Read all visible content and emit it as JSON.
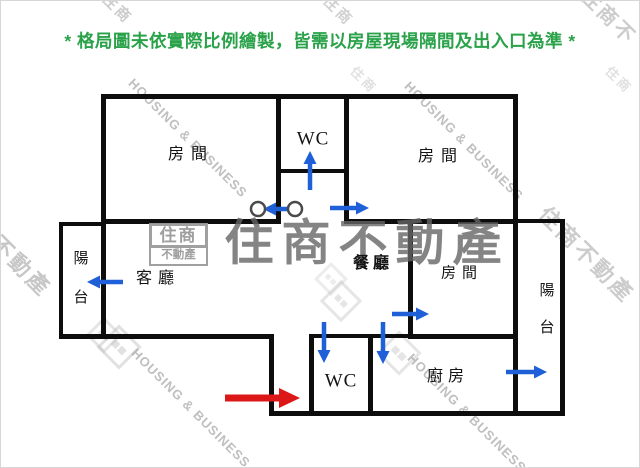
{
  "disclaimer": "* 格局圖未依實際比例繪製，皆需以房屋現場隔間及出入口為準 *",
  "colors": {
    "green": "#2aa24a",
    "blue": "#1f5fd8",
    "red": "#dc1717",
    "wall": "#0d0d0d",
    "label": "#141414",
    "watermark_dark": "#666666",
    "watermark_light": "#9a9a9a"
  },
  "brand": {
    "name_cjk": "住商不動產",
    "name_en": "HOUSING & BUSINESS",
    "logo_top": "住商",
    "logo_bottom": "不動產"
  },
  "rooms": [
    {
      "n": "bedroom-top-left",
      "label": "房間",
      "x": 190,
      "y": 154,
      "fs": 16,
      "ls": 7
    },
    {
      "n": "wc-top",
      "label": "WC",
      "x": 312,
      "y": 138,
      "fs": 19,
      "ls": 1
    },
    {
      "n": "bedroom-top-right",
      "label": "房間",
      "x": 440,
      "y": 156,
      "fs": 16,
      "ls": 7
    },
    {
      "n": "balcony-left",
      "label": "陽台",
      "x": 80,
      "y": 278,
      "fs": 15,
      "vertical": true,
      "gap": 24
    },
    {
      "n": "living-room",
      "label": "客廳",
      "x": 157,
      "y": 278,
      "fs": 16,
      "ls": 6
    },
    {
      "n": "dining-room",
      "label": "餐廳",
      "x": 372,
      "y": 263,
      "fs": 16,
      "ls": 4,
      "bold": true
    },
    {
      "n": "bedroom-middle-right",
      "label": "房間",
      "x": 461,
      "y": 273,
      "fs": 15,
      "ls": 6
    },
    {
      "n": "balcony-right",
      "label": "陽台",
      "x": 546,
      "y": 309,
      "fs": 15,
      "vertical": true,
      "gap": 22
    },
    {
      "n": "wc-bottom",
      "label": "WC",
      "x": 340,
      "y": 380,
      "fs": 19,
      "ls": 1
    },
    {
      "n": "kitchen",
      "label": "廚房",
      "x": 447,
      "y": 376,
      "fs": 16,
      "ls": 5
    }
  ],
  "walls": [
    {
      "n": "wall-top",
      "x": 100,
      "y": 93,
      "w": 417,
      "h": 5
    },
    {
      "n": "wall-left",
      "x": 100,
      "y": 93,
      "w": 5,
      "h": 245
    },
    {
      "n": "wall-balcony-left-top",
      "x": 58,
      "y": 221,
      "w": 46,
      "h": 4
    },
    {
      "n": "wall-balcony-left-side",
      "x": 58,
      "y": 221,
      "w": 4,
      "h": 116
    },
    {
      "n": "wall-living-bottom",
      "x": 58,
      "y": 333,
      "w": 215,
      "h": 5
    },
    {
      "n": "wall-entry-step",
      "x": 268,
      "y": 333,
      "w": 5,
      "h": 81
    },
    {
      "n": "wall-bottom",
      "x": 268,
      "y": 410,
      "w": 296,
      "h": 5
    },
    {
      "n": "wall-corridor-left",
      "x": 275,
      "y": 93,
      "w": 5,
      "h": 130
    },
    {
      "n": "wall-corridor-right",
      "x": 343,
      "y": 93,
      "w": 5,
      "h": 130
    },
    {
      "n": "wall-wc-top-bottom",
      "x": 275,
      "y": 168,
      "w": 72,
      "h": 4
    },
    {
      "n": "wall-bedroom1-bottom",
      "x": 100,
      "y": 218,
      "w": 180,
      "h": 5
    },
    {
      "n": "wall-bedroom2-bottom",
      "x": 343,
      "y": 218,
      "w": 174,
      "h": 5
    },
    {
      "n": "wall-right-main",
      "x": 512,
      "y": 93,
      "w": 5,
      "h": 322
    },
    {
      "n": "wall-balcony-right-top",
      "x": 512,
      "y": 218,
      "w": 51,
      "h": 4
    },
    {
      "n": "wall-balcony-right-side",
      "x": 559,
      "y": 218,
      "w": 5,
      "h": 197
    },
    {
      "n": "wall-bedroom3-left",
      "x": 407,
      "y": 218,
      "w": 5,
      "h": 120
    },
    {
      "n": "wall-bedroom3-bottom",
      "x": 407,
      "y": 333,
      "w": 110,
      "h": 5
    },
    {
      "n": "wall-kitchen-top",
      "x": 367,
      "y": 333,
      "w": 45,
      "h": 4
    },
    {
      "n": "wall-wc-bottom-left",
      "x": 308,
      "y": 333,
      "w": 5,
      "h": 81
    },
    {
      "n": "wall-wc-bottom-right",
      "x": 367,
      "y": 333,
      "w": 5,
      "h": 81
    },
    {
      "n": "wall-wc-bottom-top",
      "x": 308,
      "y": 333,
      "w": 63,
      "h": 4
    }
  ],
  "arrows": [
    {
      "n": "arrow-wc-top-door",
      "x1": 309,
      "y1": 189,
      "x2": 309,
      "y2": 150,
      "color": "blue"
    },
    {
      "n": "arrow-door-swing",
      "x1": 288,
      "y1": 208,
      "x2": 262,
      "y2": 208,
      "color": "blue"
    },
    {
      "n": "arrow-bedroom-top-right-door",
      "x1": 329,
      "y1": 207,
      "x2": 368,
      "y2": 207,
      "color": "blue"
    },
    {
      "n": "arrow-balcony-left-window",
      "x1": 122,
      "y1": 281,
      "x2": 86,
      "y2": 281,
      "color": "blue"
    },
    {
      "n": "arrow-bedroom-mid-right-door",
      "x1": 391,
      "y1": 313,
      "x2": 428,
      "y2": 313,
      "color": "blue"
    },
    {
      "n": "arrow-wc-bottom-door",
      "x1": 323,
      "y1": 321,
      "x2": 323,
      "y2": 362,
      "color": "blue"
    },
    {
      "n": "arrow-kitchen-door",
      "x1": 382,
      "y1": 321,
      "x2": 382,
      "y2": 363,
      "color": "blue"
    },
    {
      "n": "arrow-balcony-right-window",
      "x1": 505,
      "y1": 371,
      "x2": 546,
      "y2": 371,
      "color": "blue"
    },
    {
      "n": "arrow-entrance",
      "x1": 224,
      "y1": 397,
      "x2": 299,
      "y2": 397,
      "color": "red"
    }
  ],
  "door_circles": [
    {
      "n": "door-hinge-circle-left",
      "x": 257,
      "y": 208,
      "r": 7
    },
    {
      "n": "door-hinge-circle-right",
      "x": 294,
      "y": 208,
      "r": 7
    }
  ],
  "watermarks": {
    "center": {
      "text": "住商不動產",
      "x": 366,
      "y": 243,
      "fs": 49
    },
    "logo_box": {
      "x": 148,
      "y": 222,
      "w": 59
    },
    "housing": [
      {
        "x": 187,
        "y": 137
      },
      {
        "x": 463,
        "y": 140
      },
      {
        "x": 190,
        "y": 407
      },
      {
        "x": 466,
        "y": 412
      }
    ],
    "edge_cjk": [
      {
        "text": "住商不動產",
        "x": 2,
        "y": 248,
        "fs": 22,
        "o": 0.55
      },
      {
        "text": "住商不動產",
        "x": 585,
        "y": 254,
        "fs": 22,
        "o": 0.5
      },
      {
        "text": "住商",
        "x": 116,
        "y": 8,
        "fs": 15,
        "o": 0.5
      },
      {
        "text": "住商",
        "x": 337,
        "y": 10,
        "fs": 15,
        "o": 0.45
      },
      {
        "text": "住商不",
        "x": 607,
        "y": 16,
        "fs": 20,
        "o": 0.5
      },
      {
        "text": "住商",
        "x": 363,
        "y": 79,
        "fs": 13,
        "o": 0.3
      },
      {
        "text": "住商",
        "x": 618,
        "y": 79,
        "fs": 13,
        "o": 0.3
      }
    ],
    "diamonds": [
      {
        "x": 118,
        "y": 346,
        "s": 26,
        "o": 0.35
      },
      {
        "x": 340,
        "y": 300,
        "s": 24,
        "o": 0.3
      },
      {
        "x": 398,
        "y": 352,
        "s": 26,
        "o": 0.3
      },
      {
        "x": 103,
        "y": 334,
        "s": 20,
        "o": 0.3
      },
      {
        "x": 330,
        "y": 278,
        "s": 18,
        "o": 0.22
      }
    ]
  }
}
